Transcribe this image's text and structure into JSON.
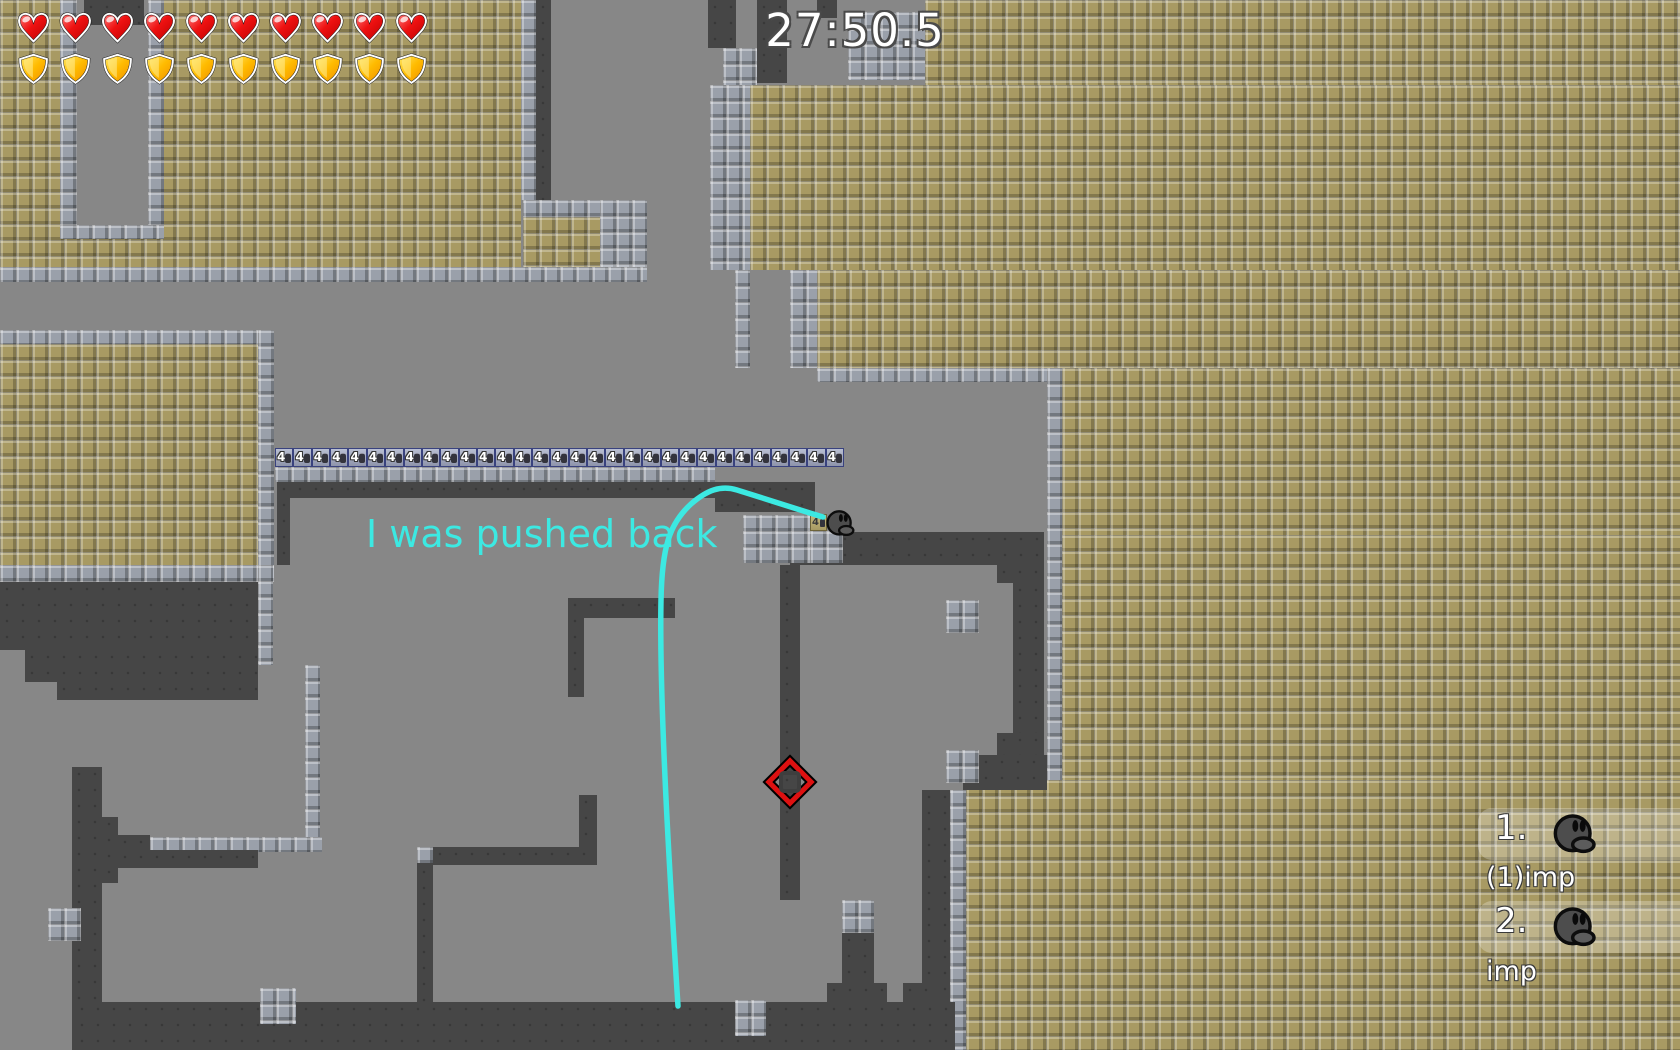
{
  "hud": {
    "timer": "27:50.5",
    "hearts_count": 10,
    "shields_count": 10
  },
  "message": {
    "text": "I was pushed back"
  },
  "map": {
    "teleport_row": {
      "count": 31,
      "label": "4"
    },
    "spawn_tile": {
      "label": "4"
    }
  },
  "scoreboard": {
    "entries": [
      {
        "rank": "1.",
        "name": "(1)imp"
      },
      {
        "rank": "2.",
        "name": "imp"
      }
    ]
  },
  "colors": {
    "background_gray": "#878787",
    "dark_rock": "#464646",
    "tan_tile": "#a89a63",
    "brick_tile": "#9aa0aa",
    "path_cyan": "#3ce9e2",
    "marker_red": "#dd1111",
    "heart_red": "#e00000",
    "shield_gold": "#f5a800",
    "timer_white": "#ffffff"
  }
}
